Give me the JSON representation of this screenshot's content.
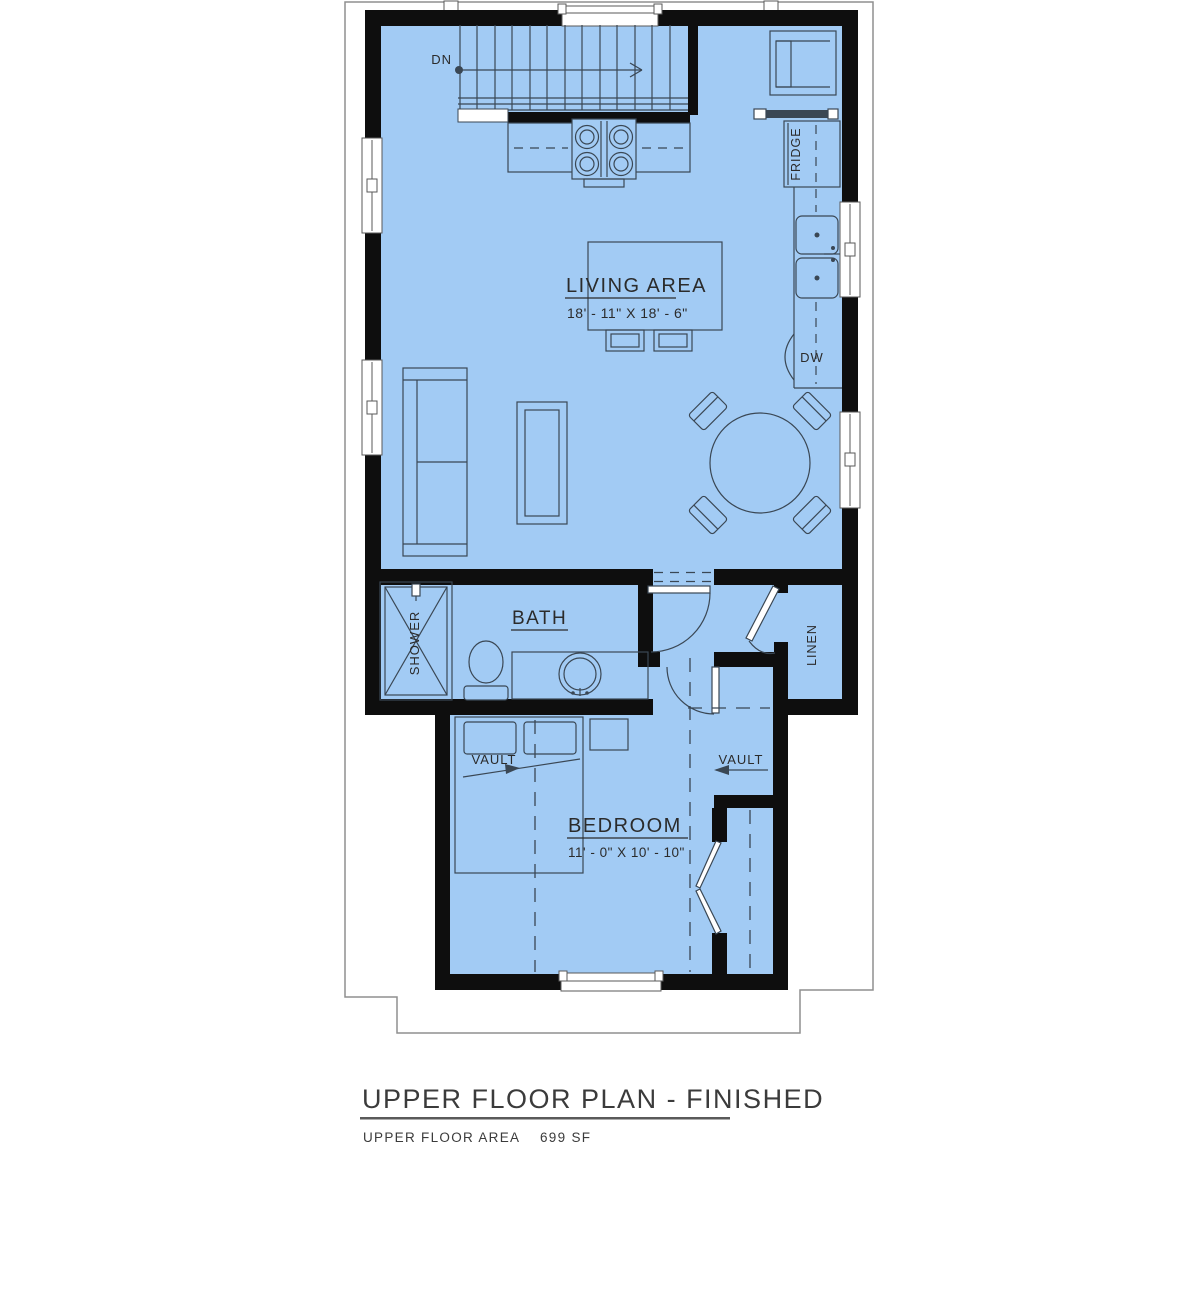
{
  "labels": {
    "dn": "DN",
    "living_area": "LIVING AREA",
    "living_dims": "18' - 11\" X 18' - 6\"",
    "fridge": "FRIDGE",
    "dw": "DW",
    "bath": "BATH",
    "shower": "SHOWER",
    "linen": "LINEN",
    "vault_left": "VAULT",
    "vault_right": "VAULT",
    "bedroom": "BEDROOM",
    "bedroom_dims": "11' - 0\" X 10' - 10\""
  },
  "title_block": {
    "title": "UPPER FLOOR PLAN - FINISHED",
    "area_label": "UPPER FLOOR AREA",
    "area_value": "699 SF"
  },
  "colors": {
    "floor_fill": "#a2cbf4",
    "wall": "#0e0e0e",
    "drawing_line": "#3a4754",
    "roof_outline": "#8f8f8f",
    "text": "#2b2b2b"
  }
}
